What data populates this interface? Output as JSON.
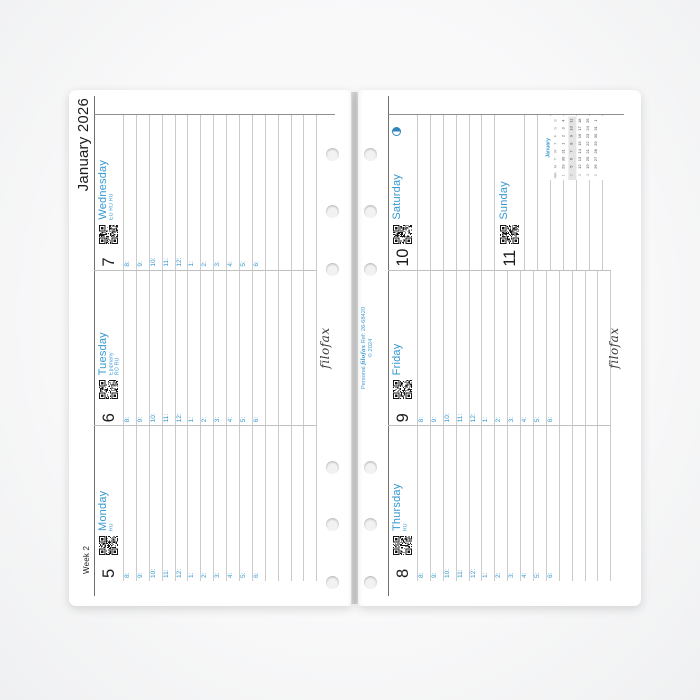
{
  "header": {
    "week_label": "Week 2",
    "month_label": "January 2026"
  },
  "branding": {
    "logo": "filofax",
    "ref_prefix": "Personal",
    "ref_brand": "filofax",
    "ref_suffix": "Ref: 26-68420",
    "copyright": "© 2024"
  },
  "timeslots": [
    "8:",
    "9:",
    "10:",
    "11:",
    "12:",
    "1:",
    "2:",
    "3:",
    "4:",
    "5:",
    "6:"
  ],
  "days": [
    {
      "num": "5",
      "name": "Monday",
      "notes": [
        "RU"
      ]
    },
    {
      "num": "6",
      "name": "Tuesday",
      "notes": [
        "Epiphany",
        "RO RU"
      ]
    },
    {
      "num": "7",
      "name": "Wednesday",
      "notes": [
        "EG RO RU"
      ]
    },
    {
      "num": "8",
      "name": "Thursday",
      "notes": [
        "RU"
      ]
    },
    {
      "num": "9",
      "name": "Friday",
      "notes": []
    },
    {
      "num": "10",
      "name": "Saturday",
      "notes": [],
      "moon_phase": "last-quarter"
    },
    {
      "num": "11",
      "name": "Sunday",
      "notes": []
    }
  ],
  "mini_calendar": {
    "title": "January",
    "col_headers": [
      "WK",
      "M",
      "T",
      "W",
      "T",
      "F",
      "S",
      "S"
    ],
    "rows": [
      [
        "1",
        "29",
        "30",
        "31",
        "1",
        "2",
        "3",
        "4"
      ],
      [
        "2",
        "5",
        "6",
        "7",
        "8",
        "9",
        "10",
        "11"
      ],
      [
        "3",
        "12",
        "13",
        "14",
        "15",
        "16",
        "17",
        "18"
      ],
      [
        "4",
        "19",
        "20",
        "21",
        "22",
        "23",
        "24",
        "25"
      ],
      [
        "5",
        "26",
        "27",
        "28",
        "29",
        "30",
        "31",
        "1"
      ]
    ],
    "highlighted_week_row": 1
  },
  "colors": {
    "accent": "#3598d2",
    "ink": "#1d1d1f",
    "rule": "#cbcbcb",
    "dark_rule": "#6f6f6f",
    "week_highlight": "#e4e4e4"
  }
}
